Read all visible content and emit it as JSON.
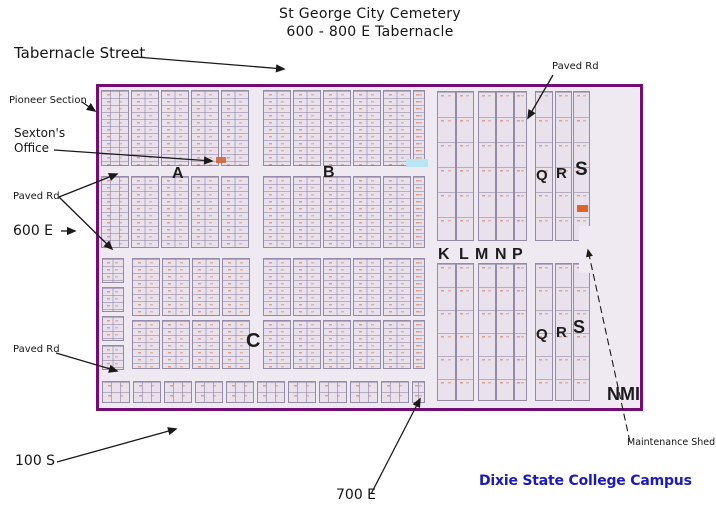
{
  "title": {
    "line1": "St George City Cemetery",
    "line2": "600 - 800 E Tabernacle"
  },
  "callouts": {
    "tabernacle_street": "Tabernacle Street",
    "pioneer_section": "Pioneer Section",
    "sextons_office_line1": "Sexton's",
    "sextons_office_line2": "Office",
    "paved_rd_left": "Paved Rd",
    "e600": "600 E",
    "paved_rd_bottom": "Paved Rd",
    "s100": "100 S",
    "e700": "700 E",
    "paved_rd_top_right": "Paved Rd",
    "maintenance_shed": "Maintenance Shed",
    "dixie_state": "Dixie State College Campus"
  },
  "map": {
    "sections": {
      "a": "A",
      "b": "B",
      "c": "C",
      "klmnp": [
        "K",
        "L",
        "M",
        "N",
        "P"
      ],
      "qrs_top": [
        "Q",
        "R",
        "S"
      ],
      "qrs_bottom": [
        "Q",
        "R",
        "S"
      ],
      "nmi": "NMI"
    },
    "colors": {
      "map_border": "#750c75",
      "map_interior": "#efe9f2",
      "block_fill": "#e9e2ec",
      "grid_line": "#8d81a0",
      "plot_mark": "#c96a45",
      "highlight_plot": "#e2622c",
      "blue_mark": "#b9e4f1",
      "campus_text": "#1a1abe"
    }
  }
}
